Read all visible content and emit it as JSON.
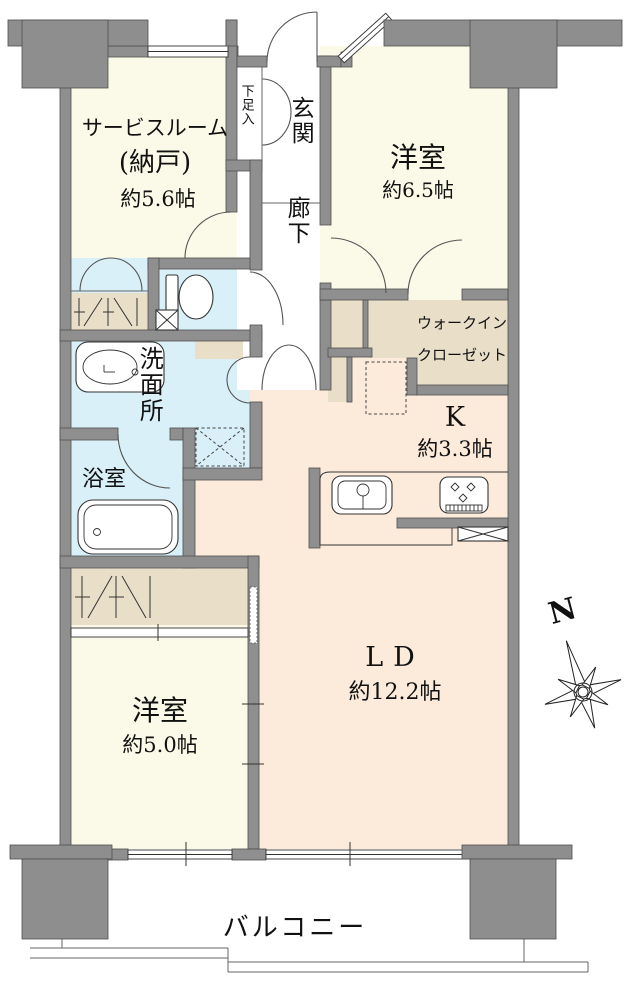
{
  "palette": {
    "wall": "#8f8f8f",
    "wall_outline": "#4f4f4f",
    "cream": "#FBFAE8",
    "peach": "#FCEBDB",
    "blue": "#D9F0F8",
    "tan": "#E9DFC9",
    "white": "#FFFFFF"
  },
  "rooms": {
    "service_room": {
      "name": "サービスルーム",
      "sub": "(納戸)",
      "size": "約5.6帖"
    },
    "shoe_cabinet": {
      "name": "下足入"
    },
    "entrance": {
      "name": "玄関"
    },
    "hallway": {
      "name": "廊下"
    },
    "bedroom_a": {
      "name": "洋室",
      "size": "約6.5帖"
    },
    "walk_in_closet": {
      "line1": "ウォークイン",
      "line2": "クローゼット"
    },
    "kitchen": {
      "name": "K",
      "size": "約3.3帖"
    },
    "washroom": {
      "name": "洗面所"
    },
    "bathroom": {
      "name": "浴室"
    },
    "bedroom_b": {
      "name": "洋室",
      "size": "約5.0帖"
    },
    "living_dining": {
      "name": "LD",
      "size": "約12.2帖"
    },
    "balcony": {
      "name": "バルコニー"
    }
  },
  "compass": {
    "label": "N"
  }
}
